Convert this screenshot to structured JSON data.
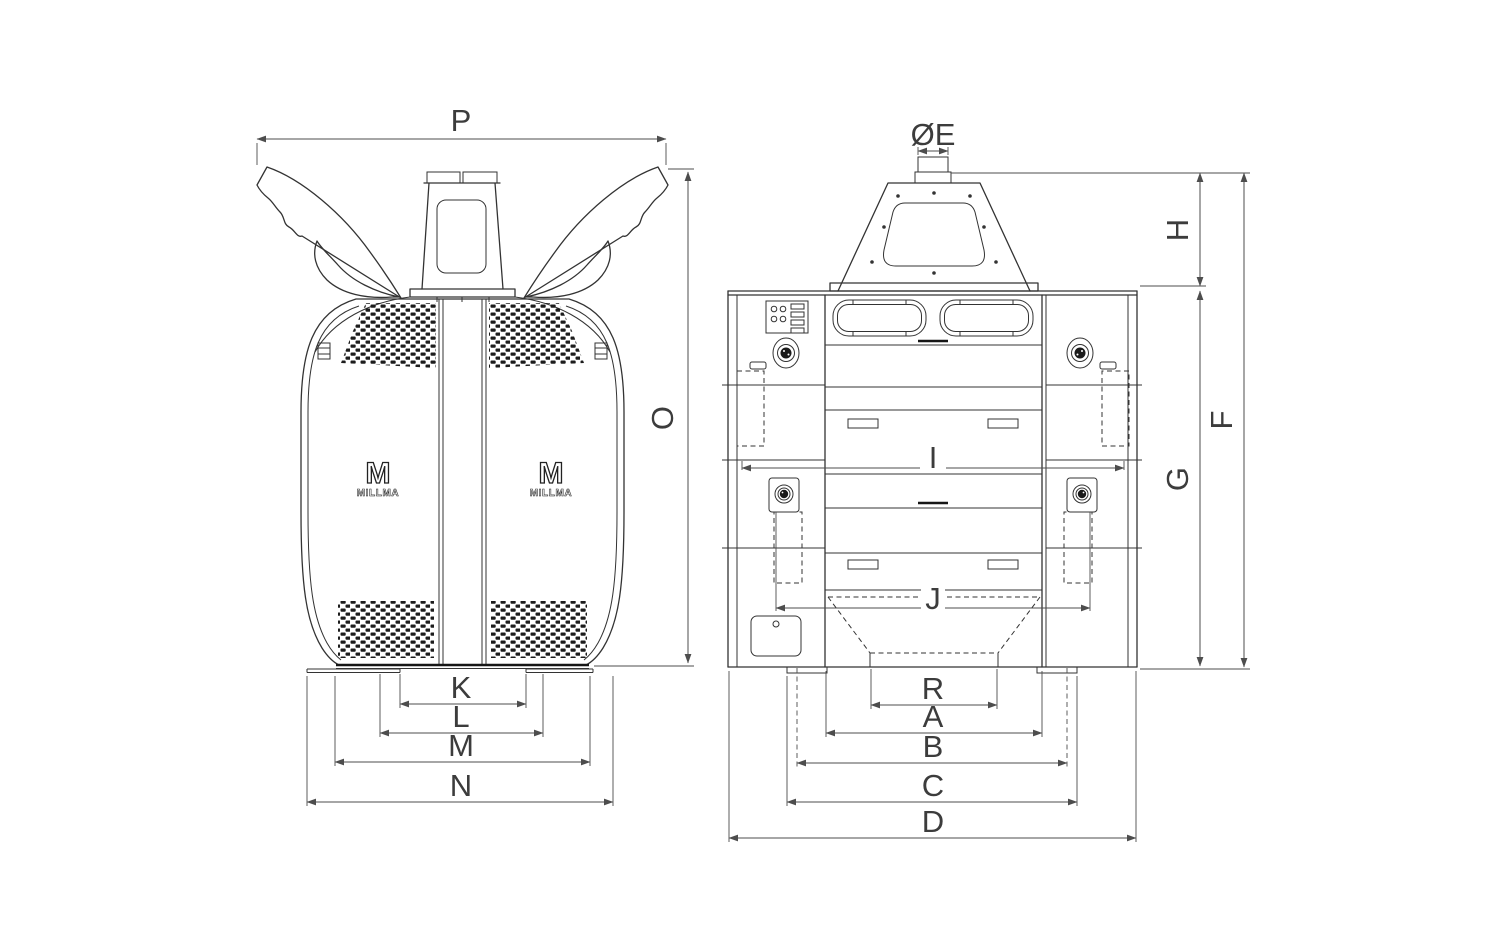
{
  "drawing": {
    "type": "technical-dimension-drawing",
    "subject": "roller mill machine, front and side elevation views"
  },
  "colors": {
    "background": "#ffffff",
    "machine_line": "#333333",
    "dimension_line": "#4d4d4d",
    "perforation": "#1c1c1c"
  },
  "brand": {
    "logo_mark": "M",
    "logo_text": "MILLMA"
  },
  "views": {
    "front": {
      "title": "front-view",
      "dimensions": {
        "P": "P",
        "O": "O",
        "K": "K",
        "L": "L",
        "M": "M",
        "N": "N"
      }
    },
    "side": {
      "title": "side-view",
      "dimensions": {
        "E": "ØE",
        "H": "H",
        "F": "F",
        "G": "G",
        "I": "I",
        "J": "J",
        "R": "R",
        "A": "A",
        "B": "B",
        "C": "C",
        "D": "D"
      }
    }
  }
}
